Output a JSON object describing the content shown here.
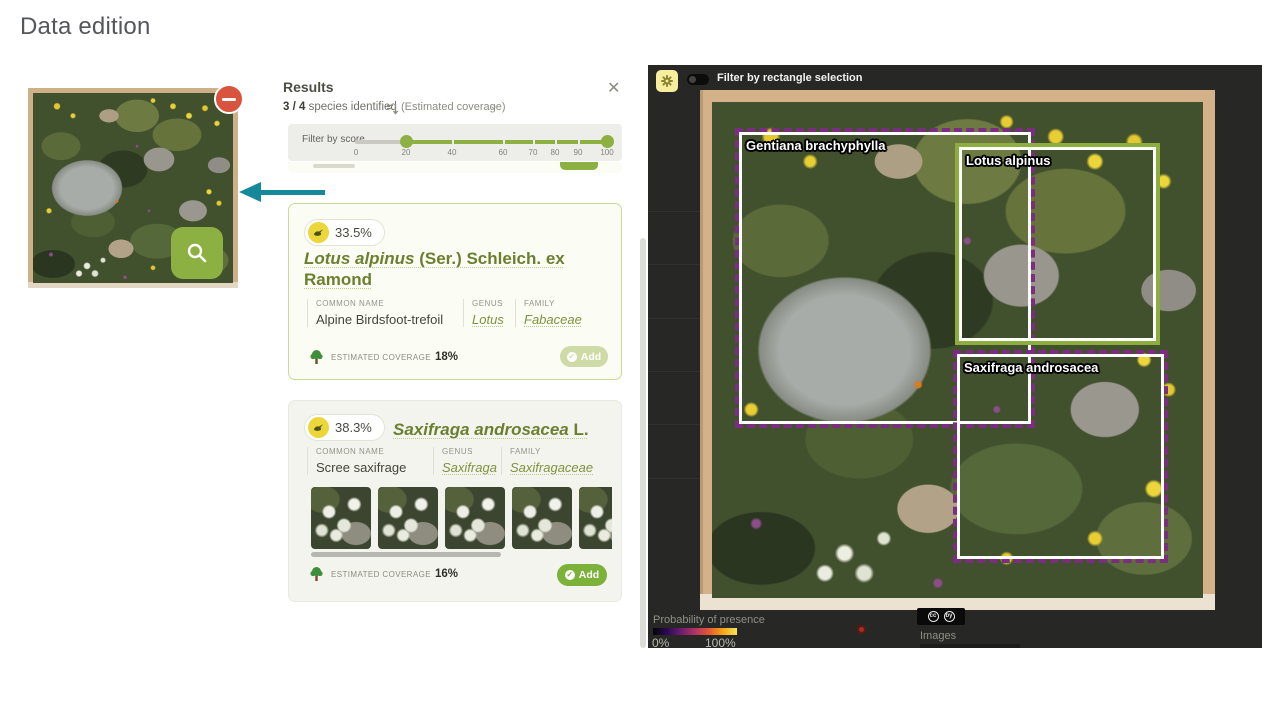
{
  "page": {
    "title": "Data edition"
  },
  "icons": {
    "close": "✕",
    "chevron": "⌄",
    "check": "✓",
    "cc": "cc",
    "by": "by"
  },
  "results": {
    "title": "Results",
    "summary": {
      "count": "3 / 4",
      "text": "species identified",
      "sort": "(Estimated coverage)"
    },
    "filter": {
      "label": "Filter by score",
      "ticks": [
        "0",
        "20",
        "40",
        "60",
        "70",
        "80",
        "90",
        "100"
      ],
      "selected_range": [
        20,
        100
      ]
    },
    "labels": {
      "common": "COMMON NAME",
      "genus": "GENUS",
      "family": "FAMILY",
      "coverage": "ESTIMATED COVERAGE"
    },
    "cards": [
      {
        "score": "33.5%",
        "sci": "Lotus alpinus",
        "auth": " (Ser.) Schleich. ex Ramond",
        "common": "Alpine Birdsfoot-trefoil",
        "genus": "Lotus",
        "family": "Fabaceae",
        "coverage": "18%",
        "add": "Add",
        "add_state": "disabled"
      },
      {
        "score": "38.3%",
        "sci": "Saxifraga androsacea",
        "auth": " L.",
        "common": "Scree saxifrage",
        "genus": "Saxifraga",
        "family": "Saxifragaceae",
        "coverage": "16%",
        "add": "Add",
        "add_state": "enabled",
        "thumbnail_count": 5
      }
    ]
  },
  "viewer": {
    "toggle_label": "Filter by rectangle selection",
    "toggle_state": "off",
    "boxes": [
      {
        "label": "Gentiana brachyphylla",
        "style": "dashed-purple"
      },
      {
        "label": "Lotus alpinus",
        "style": "solid-green"
      },
      {
        "label": "Saxifraga androsacea",
        "style": "dashed-purple"
      }
    ],
    "legend": {
      "title": "Probability of presence",
      "min": "0%",
      "max": "100%"
    },
    "images_label": "Images"
  },
  "colors": {
    "accent_green": "#7cb13a",
    "box_purple": "#7c2d82",
    "arrow_teal": "#15889c",
    "remove_red": "#d8543e",
    "score_yellow": "#ecd63a"
  }
}
